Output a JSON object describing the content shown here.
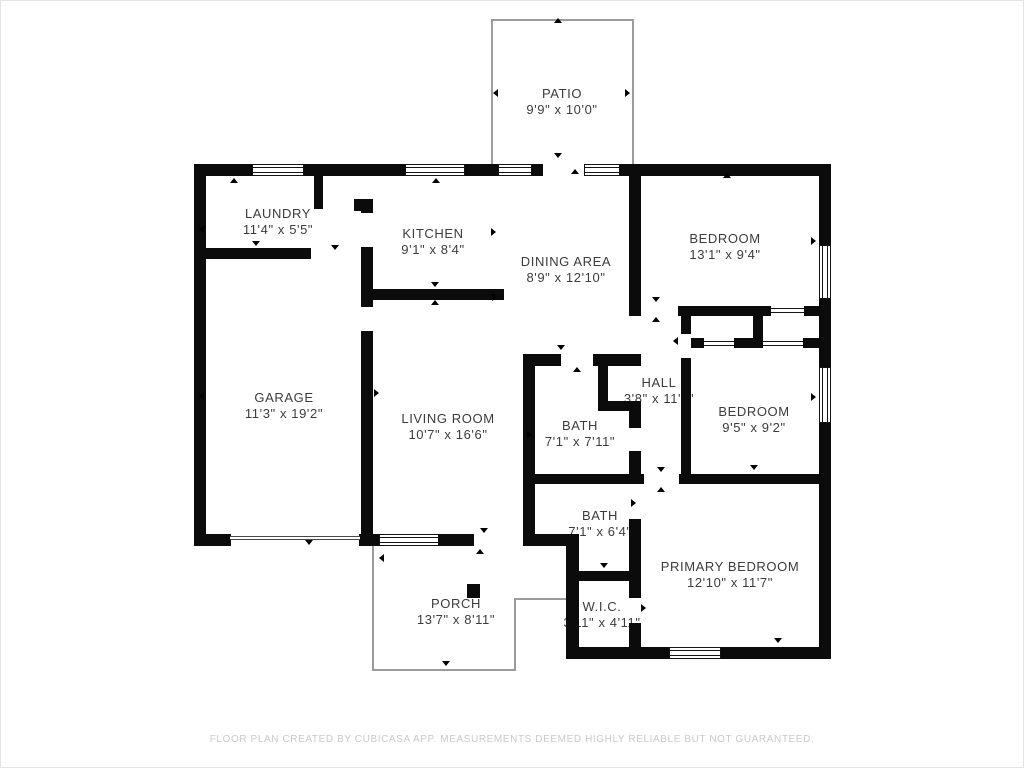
{
  "meta": {
    "footer": "FLOOR PLAN CREATED BY CUBICASA APP. MEASUREMENTS DEEMED HIGHLY RELIABLE BUT NOT GUARANTEED."
  },
  "colors": {
    "wall": "#0b0b0b",
    "outline": "#9c9c9c",
    "label": "#3c3c3c",
    "footer": "#c9c9c9",
    "background": "#ffffff"
  },
  "rooms": [
    {
      "id": "patio",
      "name": "PATIO",
      "dims": "9'9\" x 10'0\""
    },
    {
      "id": "laundry",
      "name": "LAUNDRY",
      "dims": "11'4\" x 5'5\""
    },
    {
      "id": "kitchen",
      "name": "KITCHEN",
      "dims": "9'1\" x 8'4\""
    },
    {
      "id": "dining",
      "name": "DINING AREA",
      "dims": "8'9\" x 12'10\""
    },
    {
      "id": "bedroom1",
      "name": "BEDROOM",
      "dims": "13'1\" x 9'4\""
    },
    {
      "id": "garage",
      "name": "GARAGE",
      "dims": "11'3\" x 19'2\""
    },
    {
      "id": "living",
      "name": "LIVING ROOM",
      "dims": "10'7\" x 16'6\""
    },
    {
      "id": "bath1",
      "name": "BATH",
      "dims": "7'1\" x 7'11\""
    },
    {
      "id": "hall",
      "name": "HALL",
      "dims": "3'8\" x 11'4\""
    },
    {
      "id": "bedroom2",
      "name": "BEDROOM",
      "dims": "9'5\" x 9'2\""
    },
    {
      "id": "bath2",
      "name": "BATH",
      "dims": "7'1\" x 6'4\""
    },
    {
      "id": "primary",
      "name": "PRIMARY BEDROOM",
      "dims": "12'10\" x 11'7\""
    },
    {
      "id": "wic",
      "name": "W.I.C.",
      "dims": "3'11\" x 4'11\""
    },
    {
      "id": "porch",
      "name": "PORCH",
      "dims": "13'7\" x 8'11\""
    }
  ]
}
